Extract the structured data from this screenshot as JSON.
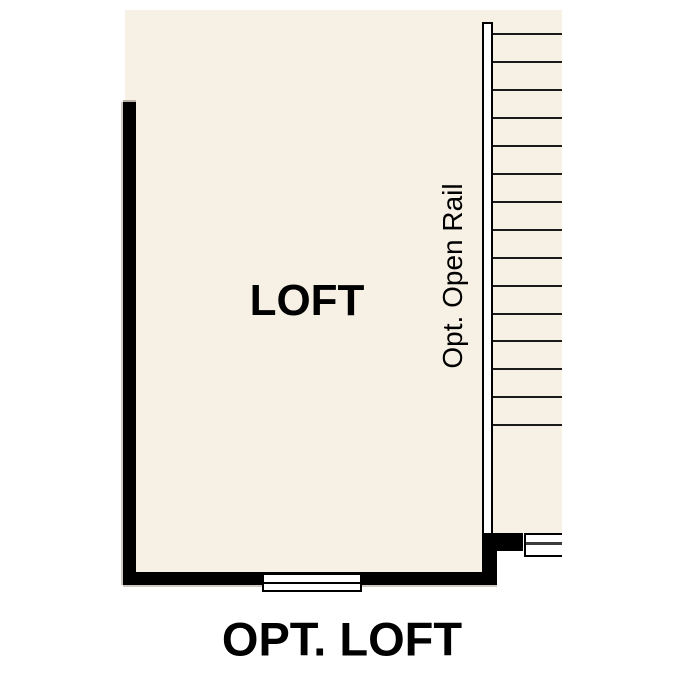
{
  "floor_plan": {
    "caption": "OPT. LOFT",
    "room": {
      "label": "LOFT"
    },
    "rail": {
      "label": "Opt. Open Rail"
    },
    "stairs": {
      "tread_count": 15,
      "first_tread_y": 33,
      "tread_spacing": 27.95
    },
    "colors": {
      "background": "#ffffff",
      "floor_fill": "#f7f0e4",
      "wall": "#000000",
      "tread_line": "#1a1a1a",
      "landing_divider": "#3b3b3b",
      "rail_fill": "#ffffff",
      "label_text": "#000000"
    }
  }
}
